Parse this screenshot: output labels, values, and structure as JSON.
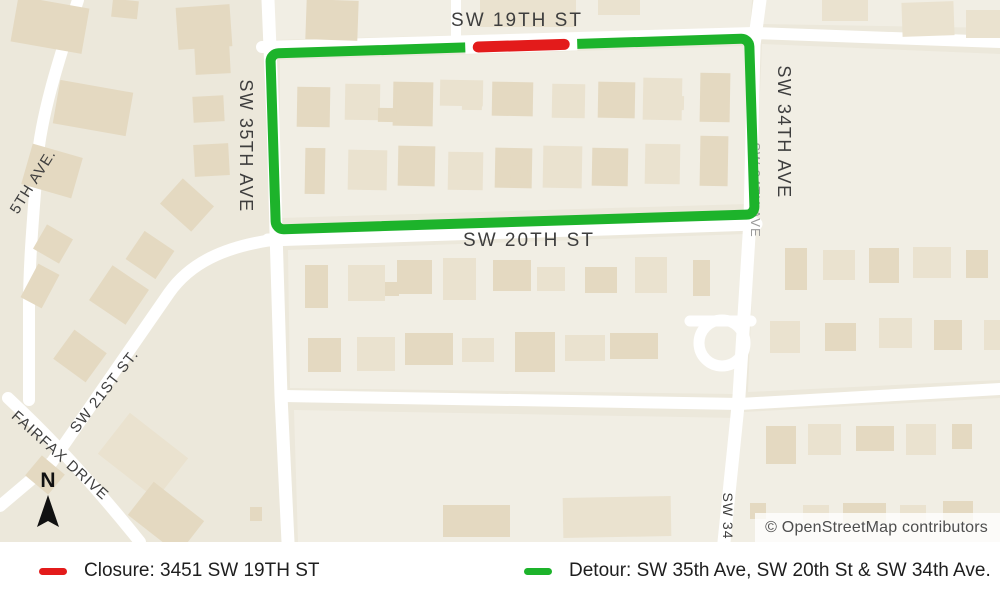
{
  "colors": {
    "detour_green": "#1db32b",
    "closure_red": "#e31b1b",
    "map_background": "#ece8db",
    "block_fill": "#f1eee4",
    "street_white": "#ffffff",
    "label_gray": "#3e3e3e",
    "legend_text": "#1e1e1e",
    "attribution_text": "#4e4e4e"
  },
  "map": {
    "width": 1000,
    "height": 542,
    "background": "#ece8db",
    "block_fill": "#f1eee4",
    "building_tones": [
      "#e4d9c1",
      "#eae2cf"
    ],
    "street_color": "#ffffff",
    "label_color": "#3e3e3e",
    "blocks": [
      "280,60 746,46 746,204 280,218",
      "288,250 746,234 734,394 290,388",
      "762,44 1000,54 1000,380 748,392",
      "744,412 1000,398 1000,542 728,542",
      "294,410 736,418 726,542 298,542",
      "764,0 1000,0 1000,28 762,24",
      "272,0 752,0 750,28 270,40"
    ],
    "streets": [
      {
        "name": "sw-35th-ave",
        "d": "M268,0 L273,120 L276,232 L281,396 L288,542",
        "w": 13
      },
      {
        "name": "sw-34th-ave",
        "d": "M760,0 L754,45 L750,220 L739,396 L724,542",
        "w": 13
      },
      {
        "name": "sw-19th-st",
        "d": "M262,47 L754,33 L1000,42",
        "w": 12
      },
      {
        "name": "sw-20th-st",
        "d": "M268,240 L756,224",
        "w": 13
      },
      {
        "name": "south-street",
        "d": "M284,396 L740,404 L1000,389",
        "w": 12
      },
      {
        "name": "north-stub",
        "d": "M456,0 L456,44",
        "w": 10
      },
      {
        "name": "west-avenue",
        "d": "M78,0 C58,62 40,118 37,165 C34,210 29,258 29,308 L29,400",
        "w": 12
      },
      {
        "name": "fairfax-drive",
        "d": "M8,398 C36,424 84,472 140,542",
        "w": 12
      },
      {
        "name": "sw-21st-st",
        "d": "M272,240 C224,247 190,263 169,293 L52,462 L0,506",
        "w": 12
      },
      {
        "name": "cul-de-sac-stub",
        "d": "M690,321 L751,321",
        "w": 11
      }
    ],
    "cul_de_sac": {
      "cx": 722,
      "cy": 343,
      "r": 23,
      "w": 11
    },
    "buildings": [
      [
        14,
        2,
        72,
        46,
        10,
        0
      ],
      [
        112,
        0,
        26,
        18,
        6,
        0
      ],
      [
        177,
        6,
        54,
        42,
        -4,
        0
      ],
      [
        306,
        0,
        52,
        40,
        2,
        0
      ],
      [
        480,
        0,
        96,
        27,
        0,
        1
      ],
      [
        598,
        0,
        42,
        15,
        0,
        1
      ],
      [
        822,
        0,
        46,
        21,
        0,
        1
      ],
      [
        902,
        2,
        52,
        34,
        -2,
        1
      ],
      [
        966,
        10,
        34,
        28,
        0,
        1
      ],
      [
        56,
        86,
        74,
        44,
        10,
        0
      ],
      [
        26,
        150,
        52,
        42,
        16,
        0
      ],
      [
        195,
        46,
        35,
        28,
        -3,
        0
      ],
      [
        193,
        96,
        31,
        26,
        -3,
        0
      ],
      [
        194,
        144,
        35,
        32,
        -3,
        0
      ],
      [
        166,
        188,
        42,
        34,
        42,
        0
      ],
      [
        38,
        230,
        30,
        28,
        30,
        0
      ],
      [
        28,
        267,
        24,
        38,
        28,
        0
      ],
      [
        97,
        274,
        44,
        42,
        34,
        0
      ],
      [
        132,
        238,
        36,
        34,
        34,
        0
      ],
      [
        60,
        338,
        40,
        36,
        36,
        0
      ],
      [
        106,
        430,
        74,
        52,
        38,
        1
      ],
      [
        134,
        497,
        64,
        42,
        38,
        0
      ],
      [
        30,
        462,
        30,
        26,
        40,
        0
      ],
      [
        297,
        87,
        33,
        40,
        1,
        0
      ],
      [
        345,
        84,
        35,
        36,
        1,
        1
      ],
      [
        393,
        82,
        40,
        44,
        1,
        0
      ],
      [
        440,
        80,
        43,
        26,
        1,
        1
      ],
      [
        492,
        82,
        41,
        34,
        1,
        0
      ],
      [
        552,
        84,
        33,
        34,
        1,
        1
      ],
      [
        598,
        82,
        37,
        36,
        1,
        0
      ],
      [
        643,
        78,
        39,
        42,
        1,
        1
      ],
      [
        700,
        73,
        30,
        49,
        1,
        0
      ],
      [
        305,
        148,
        20,
        46,
        1,
        0
      ],
      [
        348,
        150,
        39,
        40,
        1,
        1
      ],
      [
        398,
        146,
        37,
        40,
        1,
        0
      ],
      [
        448,
        152,
        35,
        38,
        1,
        1
      ],
      [
        495,
        148,
        37,
        40,
        1,
        0
      ],
      [
        543,
        146,
        39,
        42,
        1,
        1
      ],
      [
        592,
        148,
        36,
        38,
        1,
        0
      ],
      [
        645,
        144,
        35,
        40,
        1,
        1
      ],
      [
        700,
        136,
        28,
        50,
        1,
        0
      ],
      [
        378,
        108,
        18,
        14,
        1,
        0
      ],
      [
        462,
        94,
        20,
        16,
        1,
        1
      ],
      [
        511,
        166,
        16,
        16,
        1,
        0
      ],
      [
        668,
        96,
        16,
        14,
        1,
        1
      ],
      [
        305,
        265,
        23,
        43,
        0,
        0
      ],
      [
        348,
        265,
        37,
        36,
        0,
        1
      ],
      [
        397,
        260,
        35,
        34,
        0,
        0
      ],
      [
        443,
        258,
        33,
        42,
        0,
        1
      ],
      [
        493,
        260,
        38,
        31,
        0,
        0
      ],
      [
        537,
        267,
        28,
        24,
        0,
        1
      ],
      [
        585,
        267,
        32,
        26,
        0,
        0
      ],
      [
        635,
        257,
        32,
        36,
        0,
        1
      ],
      [
        693,
        260,
        17,
        36,
        0,
        0
      ],
      [
        308,
        338,
        33,
        34,
        0,
        0
      ],
      [
        357,
        337,
        38,
        34,
        0,
        1
      ],
      [
        405,
        333,
        48,
        32,
        0,
        0
      ],
      [
        462,
        338,
        32,
        24,
        0,
        1
      ],
      [
        515,
        332,
        40,
        40,
        0,
        0
      ],
      [
        565,
        335,
        40,
        26,
        0,
        1
      ],
      [
        610,
        333,
        48,
        26,
        0,
        0
      ],
      [
        385,
        282,
        14,
        14,
        0,
        0
      ],
      [
        528,
        352,
        14,
        14,
        0,
        0
      ],
      [
        785,
        248,
        22,
        42,
        0,
        0
      ],
      [
        823,
        250,
        32,
        30,
        0,
        1
      ],
      [
        869,
        248,
        30,
        35,
        0,
        0
      ],
      [
        913,
        247,
        38,
        31,
        0,
        1
      ],
      [
        966,
        250,
        22,
        28,
        0,
        0
      ],
      [
        770,
        321,
        30,
        32,
        0,
        1
      ],
      [
        825,
        323,
        31,
        28,
        0,
        0
      ],
      [
        879,
        318,
        33,
        30,
        0,
        1
      ],
      [
        934,
        320,
        28,
        30,
        0,
        0
      ],
      [
        984,
        320,
        16,
        30,
        0,
        1
      ],
      [
        766,
        426,
        30,
        38,
        0,
        0
      ],
      [
        808,
        424,
        33,
        31,
        0,
        1
      ],
      [
        856,
        426,
        38,
        25,
        0,
        0
      ],
      [
        906,
        424,
        30,
        31,
        0,
        1
      ],
      [
        952,
        424,
        20,
        25,
        0,
        0
      ],
      [
        750,
        503,
        16,
        16,
        0,
        0
      ],
      [
        803,
        505,
        26,
        18,
        0,
        1
      ],
      [
        843,
        503,
        43,
        20,
        0,
        0
      ],
      [
        900,
        505,
        26,
        18,
        0,
        1
      ],
      [
        943,
        501,
        30,
        22,
        0,
        0
      ],
      [
        443,
        505,
        67,
        32,
        0,
        0
      ],
      [
        563,
        497,
        108,
        40,
        -1,
        1
      ],
      [
        250,
        507,
        12,
        14,
        0,
        0
      ]
    ],
    "labels": [
      {
        "t": "SW 19TH ST",
        "x": 517,
        "y": 26,
        "r": 0,
        "s": 19,
        "ls": 2
      },
      {
        "t": "SW 20TH ST",
        "x": 529,
        "y": 246,
        "r": 0,
        "s": 19,
        "ls": 2
      },
      {
        "t": "SW 35TH AVE",
        "x": 240,
        "y": 146,
        "r": 90,
        "s": 18,
        "ls": 1.5
      },
      {
        "t": "SW 34TH AVE",
        "x": 778,
        "y": 132,
        "r": 90,
        "s": 18,
        "ls": 1.5
      },
      {
        "t": "SW 34TH AVE",
        "x": 751,
        "y": 190,
        "r": 90,
        "s": 13,
        "ls": 1,
        "c": "#9a9a9a"
      },
      {
        "t": "SW 34",
        "x": 723,
        "y": 516,
        "r": 90,
        "s": 14,
        "ls": 1
      },
      {
        "t": "SW 21ST ST.",
        "x": 108,
        "y": 394,
        "r": -52,
        "s": 15,
        "ls": 1
      },
      {
        "t": "FAIRFAX DRIVE",
        "x": 57,
        "y": 459,
        "r": 42,
        "s": 15,
        "ls": 1
      },
      {
        "t": "5TH AVE.",
        "x": 37,
        "y": 184,
        "r": -58,
        "s": 15,
        "ls": 1
      }
    ],
    "overlay": {
      "rotation": -1.8,
      "cx": 512,
      "cy": 134,
      "detour_rect": {
        "x": 273,
        "y": 46,
        "w": 479,
        "h": 176,
        "rx": 8,
        "stroke_width": 10
      },
      "closure_gap": {
        "x1": 468,
        "x2": 580,
        "w": 13
      },
      "closure": {
        "x1": 481,
        "x2": 567,
        "w": 11
      }
    },
    "north_label": "N",
    "attribution": "© OpenStreetMap contributors"
  },
  "legend": {
    "items": [
      {
        "name": "closure",
        "color": "#e31b1b",
        "label": "Closure: 3451 SW 19TH ST"
      },
      {
        "name": "detour",
        "color": "#1db32b",
        "label": "Detour: SW 35th Ave, SW 20th St & SW 34th Ave."
      }
    ]
  }
}
